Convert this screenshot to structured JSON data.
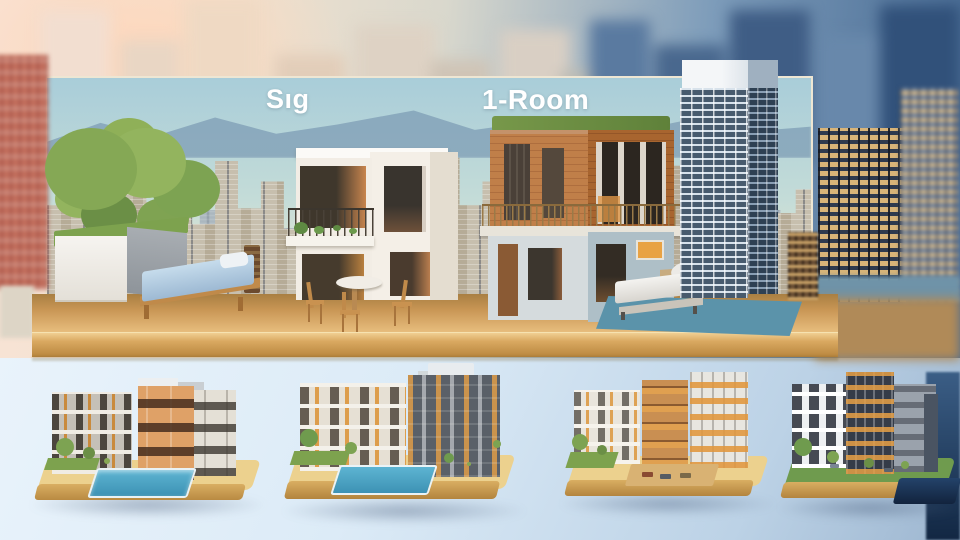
{
  "scene": {
    "kind": "3D architectural concept illustration",
    "label_left": "Sıg",
    "label_right": "1-Room",
    "top": {
      "billboard": "city-skyline-with-mountains",
      "foreground_models": [
        "tree-planter-box",
        "single-bed",
        "modern-white-house",
        "cafe-table-with-chairs",
        "brick-house-with-roof-garden",
        "daybed-on-blue-rug",
        "glass-highrise-tower"
      ],
      "platform": "wooden-tabletop"
    },
    "bottom_row_models": [
      "apartment-duo-with-pool",
      "apartment-complex-with-pool-and-trees",
      "apartment-buildings-with-courtyard-and-cars",
      "apartment-building-with-garden"
    ]
  },
  "colors": {
    "sky_warm_left": "#f8e3d5",
    "sky_blue_right": "#466992",
    "panel_sky": "#a9cdd9",
    "mountain": "#7e9cb4",
    "platform_wood": "#d9a860",
    "house_white": "#f5f1ea",
    "brick": "#b5713f",
    "lower_floor_blue_gray": "#aebfc7",
    "roof_garden_green": "#6e8f3e",
    "mattress_blue": "#aac6de",
    "rug_teal": "#5b93aa",
    "grass_green": "#7da24e",
    "pool_blue": "#4aa4c6",
    "window_glow_orange": "#e0a050",
    "gold_windows": "#d8b478",
    "bottom_background": "#dcebf7",
    "bottom_right_dark": "#122743",
    "label_text": "#ffffff"
  }
}
